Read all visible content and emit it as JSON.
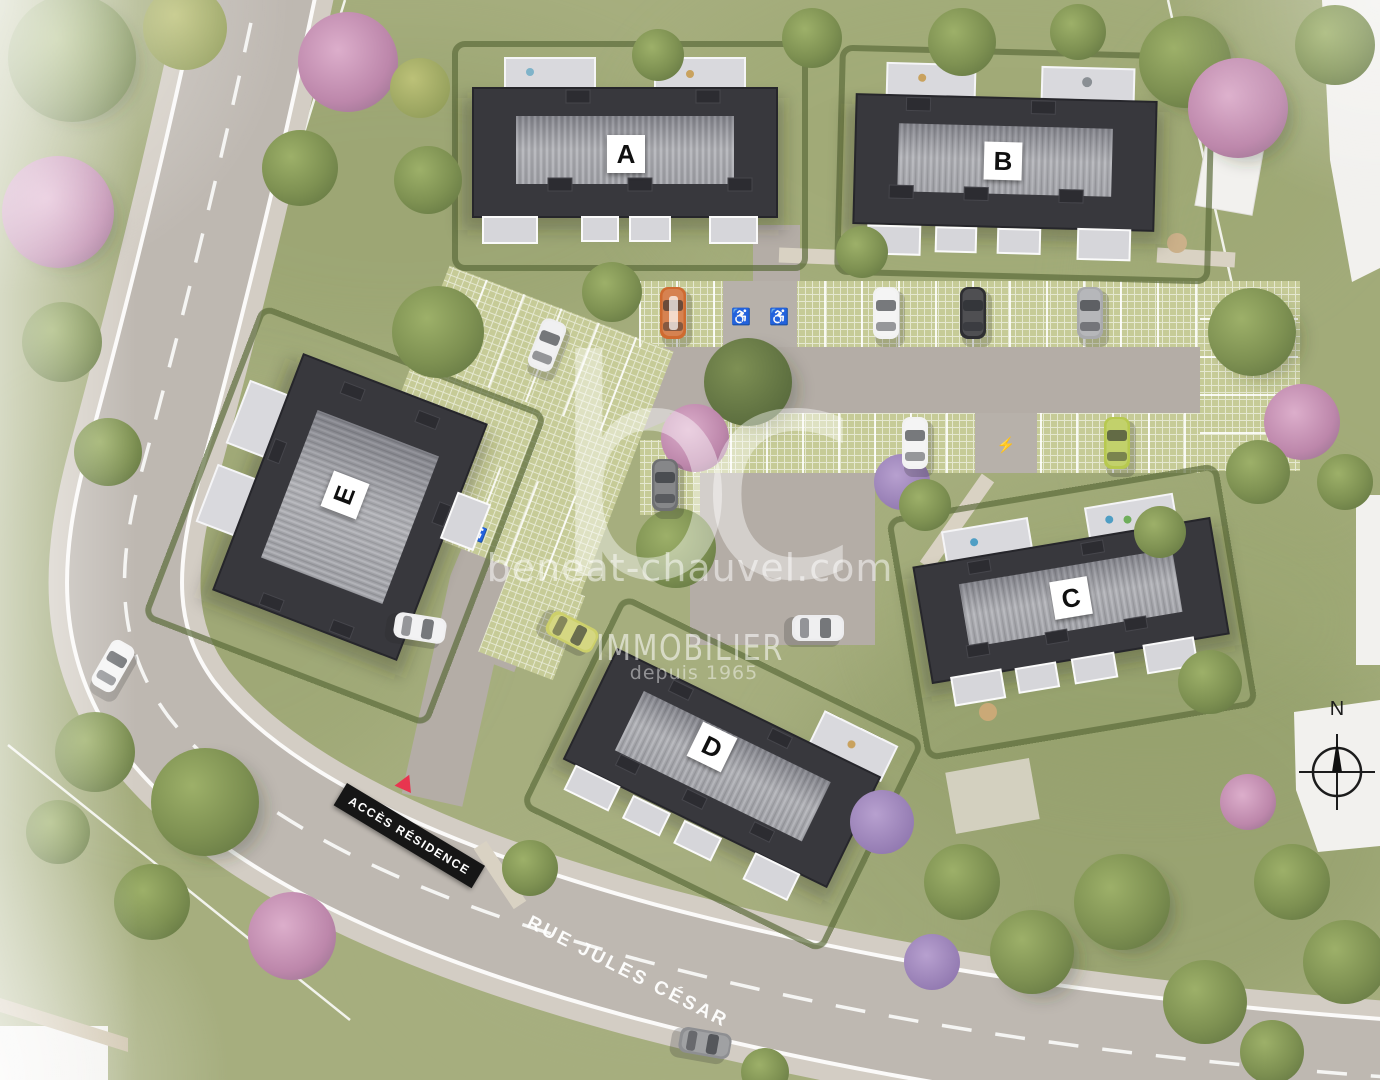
{
  "site_plan": {
    "title": "Residence site plan aerial view",
    "buildings": {
      "a": {
        "label": "A"
      },
      "b": {
        "label": "B"
      },
      "c": {
        "label": "C"
      },
      "d": {
        "label": "D"
      },
      "e": {
        "label": "E"
      }
    },
    "watermark": {
      "logo": "bc",
      "website": "beneat-chauvel.com",
      "brand": "IMMOBILIER",
      "tagline": "depuis 1965"
    },
    "road": {
      "street_name": "RUE JULES CÉSAR"
    },
    "access_sign": {
      "label": "ACCÈS RÉSIDENCE"
    },
    "compass": {
      "north_label": "N"
    },
    "icons": {
      "wheelchair": "♿",
      "ev_charging": "⚡"
    },
    "colors": {
      "lawn": "#a6ae7e",
      "road": "#beb8b1",
      "sidewalk": "#d3cdc4",
      "driveway": "#b4ada6",
      "grass_paver": "#c6cb97",
      "roof_dark": "#38383d",
      "roof_ridge": "#95969c",
      "terrace": "#d9d9dd",
      "hedge": "#5c6c3c",
      "sign_black": "#161616",
      "sign_red": "#e8354f",
      "watermark": "rgba(255,255,255,0.5)"
    }
  }
}
